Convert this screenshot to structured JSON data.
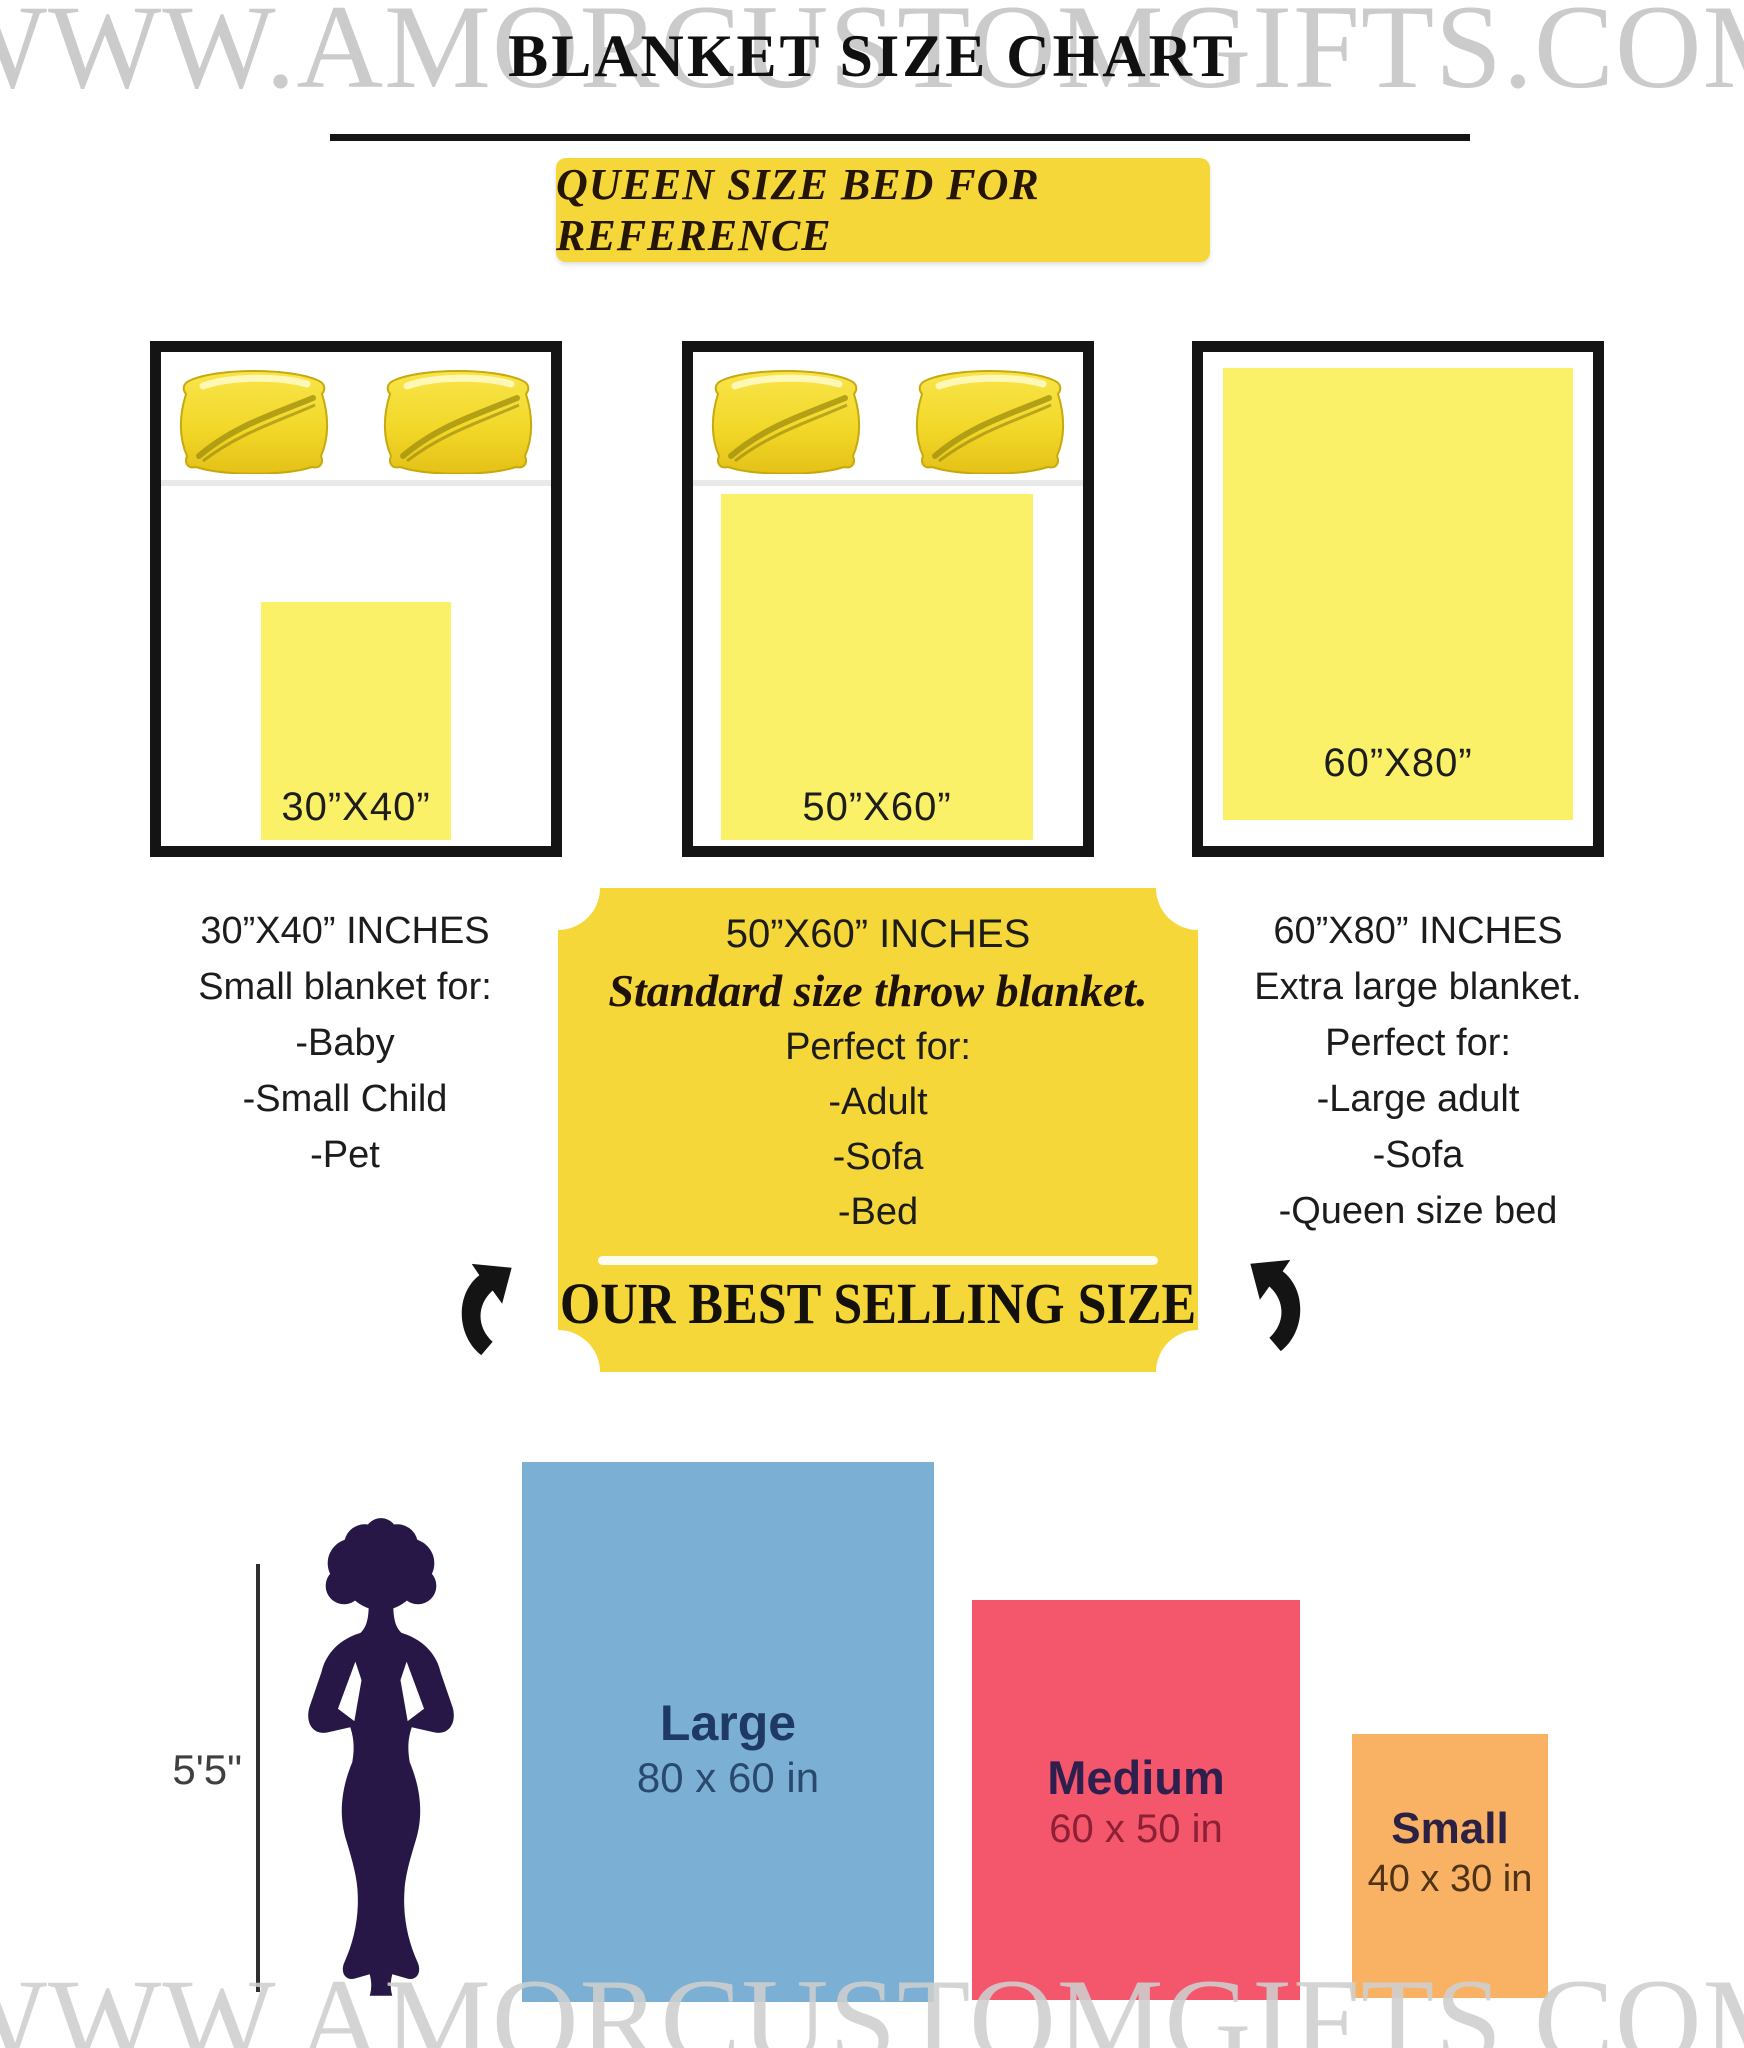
{
  "watermark": {
    "top": "WWW.AMORCUSTOMGIFTS.COM",
    "bottom": "WWW.AMORCUSTOMGIFTS.COM"
  },
  "header": {
    "title": "BLANKET SIZE CHART",
    "banner": "QUEEN SIZE BED FOR REFERENCE"
  },
  "beds": [
    {
      "blanket_label": "30”X40”",
      "has_pillows": true
    },
    {
      "blanket_label": "50”X60”",
      "has_pillows": true
    },
    {
      "blanket_label": "60”X80”",
      "has_pillows": false
    }
  ],
  "size_columns": {
    "left": {
      "title": "30”X40” INCHES",
      "subtitle": "Small blanket for:",
      "items": [
        "-Baby",
        "-Small Child",
        "-Pet"
      ]
    },
    "middle": {
      "title": "50”X60” INCHES",
      "subtitle": "Standard size throw blanket.",
      "lead": "Perfect for:",
      "items": [
        "-Adult",
        "-Sofa",
        "-Bed"
      ],
      "footer": "OUR BEST SELLING SIZE"
    },
    "right": {
      "title": "60”X80” INCHES",
      "subtitle": "Extra large blanket.",
      "lead": "Perfect for:",
      "items": [
        "-Large adult",
        "-Sofa",
        "-Queen size bed"
      ]
    }
  },
  "comparison": {
    "height_label": "5'5\"",
    "bars": [
      {
        "name": "Large",
        "size": "80 x 60 in",
        "color": "#7bb0d4"
      },
      {
        "name": "Medium",
        "size": "60 x 50 in",
        "color": "#f4566b"
      },
      {
        "name": "Small",
        "size": "40 x 30 in",
        "color": "#f9b264"
      }
    ]
  },
  "colors": {
    "accent_yellow": "#f6d73a",
    "blanket_yellow": "#faf169",
    "silhouette": "#261747",
    "watermark_gray": "#cbcbcb"
  }
}
